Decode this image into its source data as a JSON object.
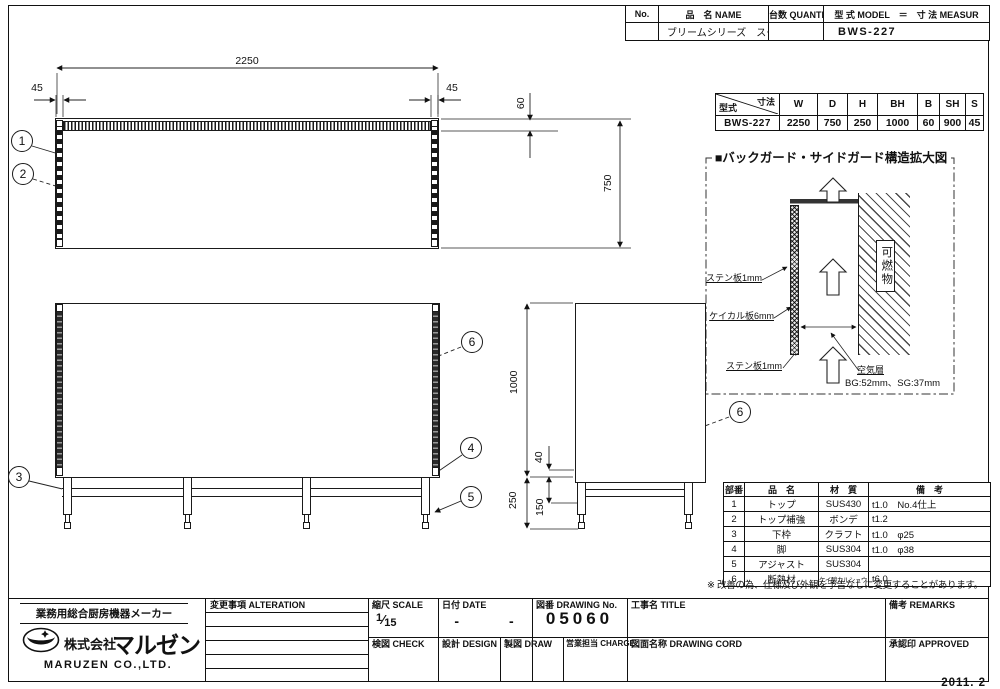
{
  "sheet": {
    "date_stamp": "2011. 2"
  },
  "header_table": {
    "no_label": "No.",
    "name_label": "品　名 NAME",
    "qty_label": "台数 QUANTITY",
    "model_label": "型 式 MODEL　＝　寸 法 MEASUR",
    "name_value": "ブリームシリーズ　スープ台",
    "model_value": "BWS-227"
  },
  "dim_table": {
    "corner_top": "寸法",
    "corner_bottom": "型式",
    "cols": [
      "W",
      "D",
      "H",
      "BH",
      "B",
      "SH",
      "S"
    ],
    "model": "BWS-227",
    "values": [
      "2250",
      "750",
      "250",
      "1000",
      "60",
      "900",
      "45"
    ]
  },
  "detail_view": {
    "title": "■バックガード・サイドガード構造拡大図",
    "sten_top": "ステン板1mm",
    "keical": "ケイカル板6mm",
    "sten_bottom": "ステン板1mm",
    "air_layer": "空気層",
    "gap_note": "BG:52mm、SG:37mm",
    "combustible": "可燃物"
  },
  "parts_table": {
    "h_no": "部番",
    "h_name": "品　名",
    "h_material": "材　質",
    "h_remarks": "備　考",
    "rows": [
      {
        "no": "1",
        "name": "トップ",
        "material": "SUS430",
        "remarks": "t1.0　No.4仕上"
      },
      {
        "no": "2",
        "name": "トップ補強",
        "material": "ボンデ",
        "remarks": "t1.2"
      },
      {
        "no": "3",
        "name": "下枠",
        "material": "クラフト",
        "remarks": "t1.0　φ25"
      },
      {
        "no": "4",
        "name": "脚",
        "material": "SUS304",
        "remarks": "t1.0　φ38"
      },
      {
        "no": "5",
        "name": "アジャスト",
        "material": "SUS304",
        "remarks": ""
      },
      {
        "no": "6",
        "name": "断熱材",
        "material": "ケイ酸カルシュウム",
        "remarks": "t6.0"
      }
    ]
  },
  "note": "※ 改善の為、仕様及び外観を予告なしに変更することがあります。",
  "dims": {
    "plan_width": "2250",
    "plan_left": "45",
    "plan_right": "45",
    "plan_guard": "60",
    "plan_depth": "750",
    "side_height": "1000",
    "side_base": "250",
    "side_return": "40",
    "side_rail": "150"
  },
  "balloons": {
    "b1": "1",
    "b2": "2",
    "b3": "3",
    "b4": "4",
    "b5": "5",
    "b6_front": "6",
    "b6_side": "6"
  },
  "title_block": {
    "tagline": "業務用総合厨房機器メーカー",
    "company_prefix": "株式会社",
    "company_logo_text": "マルゼン",
    "company_en": "MARUZEN CO.,LTD.",
    "alteration_label": "変更事項 ALTERATION",
    "scale_label": "縮尺 SCALE",
    "scale_num": "1",
    "scale_slash": "⁄",
    "scale_den": "15",
    "date_label": "日付 DATE",
    "date_value": "-　　　-",
    "drawing_no_label": "図番 DRAWING  No.",
    "drawing_no_value": "05060",
    "title_label": "工事名 TITLE",
    "remarks_label": "備考 REMARKS",
    "check_label": "検図 CHECK",
    "design_label": "設計 DESIGN",
    "draw_label": "製図 DRAW",
    "charge_label": "営業担当 CHARGE",
    "cord_label": "図面名称 DRAWING  CORD",
    "approved_label": "承認印 APPROVED"
  },
  "colors": {
    "line": "#1a1a1a",
    "paper": "#ffffff"
  }
}
